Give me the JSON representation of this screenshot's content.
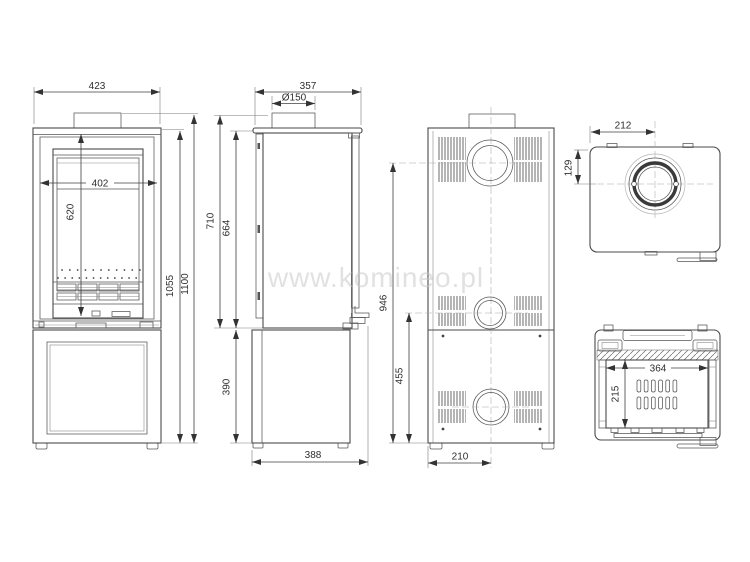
{
  "watermark": "www.komineo.pl",
  "colors": {
    "line": "#4a4a4a",
    "dimension": "#3f3f3f",
    "watermark": "#c9c9c9",
    "background": "#ffffff"
  },
  "front": {
    "width": "423",
    "door_width": "402",
    "glass_height": "620",
    "body_height": "1055",
    "total_height": "1100"
  },
  "side": {
    "depth": "357",
    "flue_diameter": "Ø150",
    "upper_height": "710",
    "firebox_height": "664",
    "base_height": "390",
    "base_depth": "388"
  },
  "rear": {
    "flue_height": "946",
    "inlet_height": "455",
    "center_offset": "210"
  },
  "top": {
    "flue_from_left": "212",
    "flue_from_rear": "129"
  },
  "firebox": {
    "width": "364",
    "depth": "215"
  }
}
